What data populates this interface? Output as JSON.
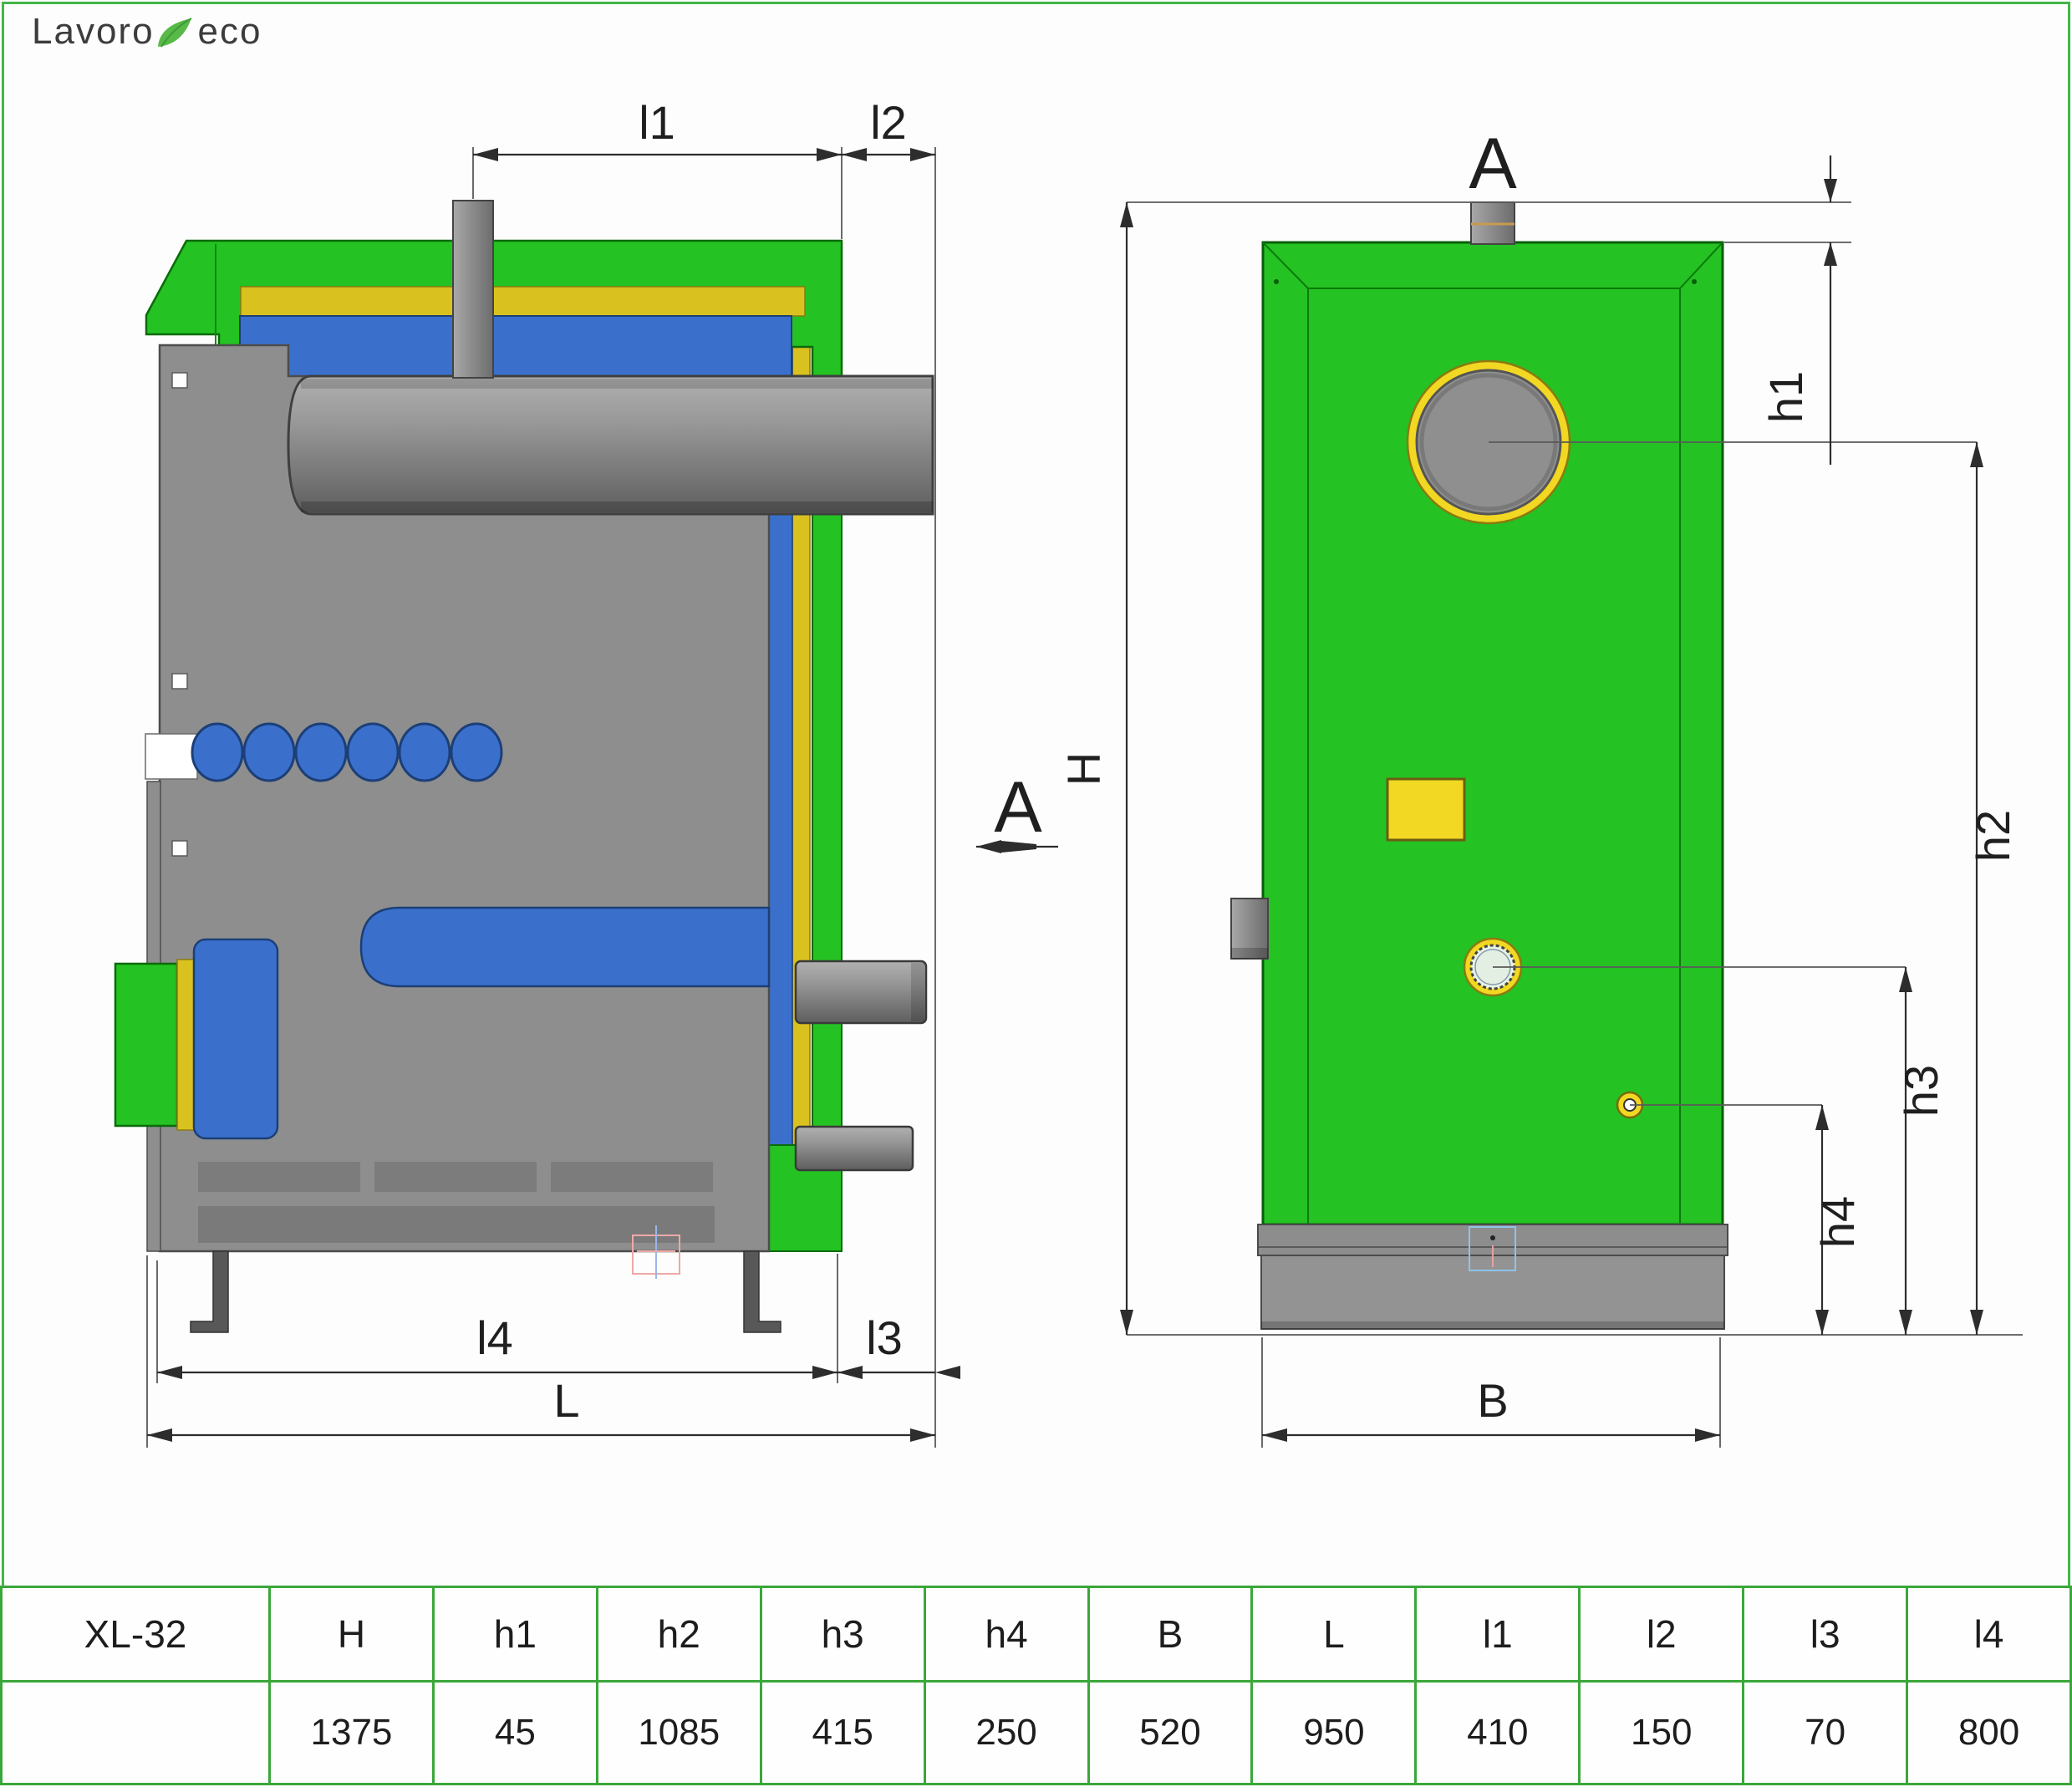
{
  "logo": {
    "word1": "Lavoro",
    "word2": "eco"
  },
  "drawing": {
    "side_view": {
      "dim_labels": {
        "l1": "l1",
        "l2": "l2",
        "l3": "l3",
        "l4": "l4",
        "length": "L",
        "section_marker": "A"
      }
    },
    "front_view": {
      "view_label": "A",
      "dim_labels": {
        "height": "H",
        "h1": "h1",
        "h2": "h2",
        "h3": "h3",
        "h4": "h4",
        "width": "B"
      }
    }
  },
  "table": {
    "headers": [
      "XL-32",
      "H",
      "h1",
      "h2",
      "h3",
      "h4",
      "B",
      "L",
      "l1",
      "l2",
      "l3",
      "l4"
    ],
    "values": [
      "",
      "1375",
      "45",
      "1085",
      "415",
      "250",
      "520",
      "950",
      "410",
      "150",
      "70",
      "800"
    ]
  },
  "colors": {
    "shell_green": "#24c223",
    "insulation_yellow": "#d9c21f",
    "water_blue": "#3a70cc",
    "steel_gray": "#8e8e8e",
    "ring_yellow": "#f2d723",
    "table_border_green": "#3aa73a",
    "page_border_green": "#43b649",
    "logo_leaf_green": "#57b947"
  }
}
